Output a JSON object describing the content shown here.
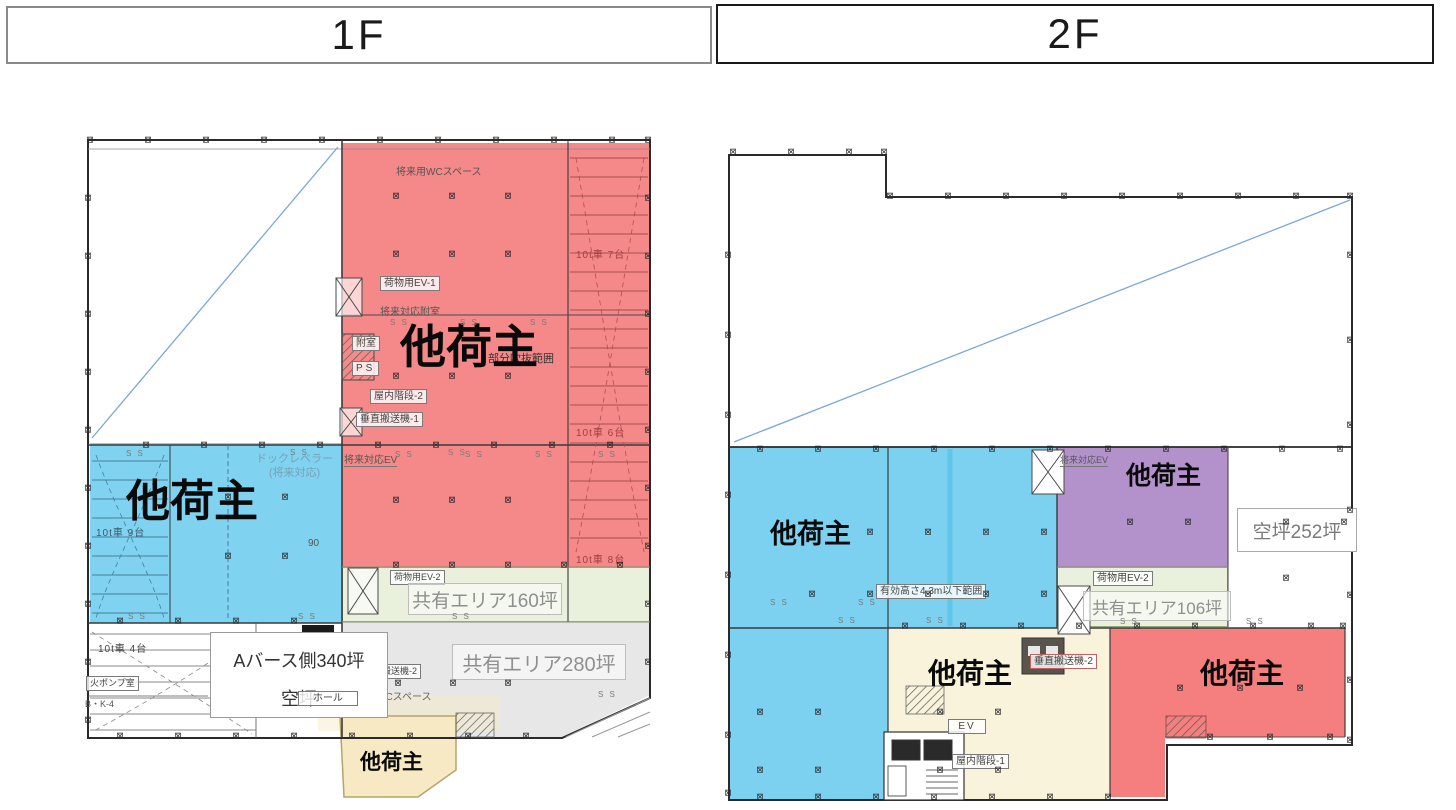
{
  "header": {
    "floor1_label": "1F",
    "floor2_label": "2F"
  },
  "common": {
    "ss_marker": "S S",
    "column_marker": "⊠"
  },
  "colors": {
    "f1_red": "#f58888",
    "f1_blue": "#7fd2f0",
    "f1_green": "#e9f0db",
    "f1_gray": "#e3e3e3",
    "f1_yellow": "#f6e9c3",
    "f2_blue": "#7cd1f1",
    "f2_purple": "#b392cc",
    "f2_cream": "#faf3dc",
    "f2_red": "#f57f7f",
    "f2_green": "#e9f0db",
    "diagonal_line": "#7aa7d9",
    "green_border": "#a9bf8e",
    "yellow_border": "#b6a468"
  },
  "floor1": {
    "tenant_red": "他荷主",
    "tenant_blue": "他荷主",
    "tenant_yellow": "他荷主",
    "vacant_box_line1": "Aバース側340坪",
    "vacant_box_line2": "空坪",
    "shared_area_160": "共有エリア160坪",
    "shared_area_280": "共有エリア280坪",
    "ann": {
      "future_wc": "将来用WCスペース",
      "cargo_ev1": "荷物用EV-1",
      "future_annex": "将来対応附室",
      "annex": "附室",
      "ps": "PS",
      "stairs2": "屋内階段-2",
      "vconv1": "垂直搬送機-1",
      "future_ev": "将来対応EV",
      "partial_void": "部分吹抜範囲",
      "trucks7": "10t車 7台",
      "trucks6": "10t車 6台",
      "trucks8": "10t車 8台",
      "trucks9": "10t車 9台",
      "trucks4": "10t車 4台",
      "dock_leveler_1": "ドックレベラー",
      "dock_leveler_2": "(将来対応)",
      "cargo_ev2": "荷物用EV-2",
      "vconv2": "垂直搬送機-2",
      "wc_space": "用WCスペース",
      "fire_pump": "火ポンプ室",
      "bk4": "B・K-4",
      "hall": "ホール",
      "dim90": "90"
    }
  },
  "floor2": {
    "tenant_blue": "他荷主",
    "tenant_purple": "他荷主",
    "tenant_cream": "他荷主",
    "tenant_red": "他荷主",
    "vacant_252": "空坪252坪",
    "shared_area_106": "共有エリア106坪",
    "ann": {
      "clear_height": "有効高さ4.3m以下範囲",
      "future_ev": "将来対応EV",
      "cargo_ev2": "荷物用EV-2",
      "vconv2": "垂直搬送機-2",
      "ev": "EV",
      "stairs1": "屋内階段-1"
    }
  }
}
